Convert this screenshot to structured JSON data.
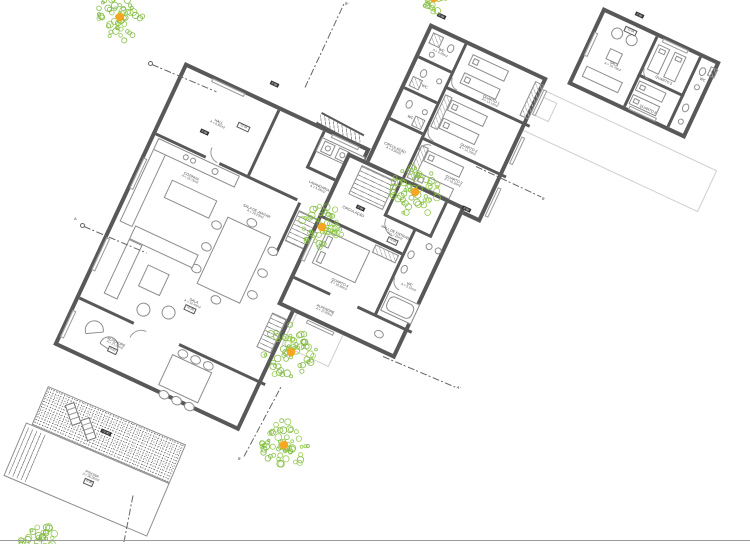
{
  "document": {
    "type": "architectural site / floor plan drawing",
    "language": "pt"
  },
  "palette": {
    "wall": "#585858",
    "line": "#8d8d8d",
    "faint": "#cfcfcf",
    "tree_green": "#8CC63E",
    "tree_green_dark": "#79B53A",
    "tree_dot": "#F5A623",
    "text": "#444444",
    "page_edge": "#9a9a9a"
  },
  "buildings": {
    "living": {
      "rooms": {
        "hall": {
          "name": "HALL",
          "area": "A = 9.60m2"
        },
        "lavandaria": {
          "name": "LAVANDARIA",
          "area": "A = 6.45m2"
        },
        "cozinha": {
          "name": "COZINHA",
          "area": "A = 18.75m2"
        },
        "jantar": {
          "name": "SALA DE JANTAR",
          "area": "A = 16.20m2"
        },
        "sala": {
          "name": "SALA",
          "area": "A = 32.40m2",
          "tag": "+0.05"
        },
        "alpendre": {
          "name": "ALPENDRE",
          "area": "A = 21.35m2",
          "tag": "0.00"
        }
      }
    },
    "bedrooms": {
      "rooms": {
        "wc1": {
          "name": "WC",
          "area": "A = 4.20m2"
        },
        "wc2": {
          "name": "WC",
          "area": "A = 3.80m2"
        },
        "wc3": {
          "name": "WC",
          "area": "A = 3.80m2"
        },
        "q1": {
          "name": "QUARTO 1",
          "area": "A = 14.10m2"
        },
        "q2": {
          "name": "QUARTO 2",
          "area": "A = 14.10m2"
        },
        "q3": {
          "name": "QUARTO 3",
          "area": "A = 15.30m2"
        },
        "circ": {
          "name": "CIRCULAÇÃO",
          "area": "A = 8.90m2"
        }
      }
    },
    "suite": {
      "rooms": {
        "hall": {
          "name": "HALL DE ENTRADA",
          "area": "A = 7.25m2",
          "tag": "+0.05"
        },
        "circ": {
          "name": "CIRCULAÇÃO",
          "area": "A = 6.40m2"
        },
        "quarto": {
          "name": "QUARTO 4",
          "area": "A = 16.80m2"
        },
        "wc": {
          "name": "WC",
          "area": "A = 5.10m2"
        },
        "alpendre": {
          "name": "ALPENDRE",
          "area": "A = 12.60m2"
        }
      }
    },
    "guest": {
      "rooms": {
        "sala": {
          "name": "SALA",
          "area": "A = 15.75m2"
        },
        "q5": {
          "name": "QUARTO 5",
          "area": "A = 12.40m2"
        },
        "q6": {
          "name": "QUARTO 6",
          "area": "A = 11.95m2"
        },
        "wc": {
          "name": "WC",
          "area": "A = 2.90m2"
        }
      }
    }
  },
  "pool": {
    "label": "PISCINA",
    "area": "A = 36.00m2",
    "tag": "-0.40",
    "deck_tag": "+0.40"
  },
  "levels": {
    "t1": "0.00",
    "t2": "+0.05",
    "t3": "0.00",
    "t4": "0.00",
    "t5": "0.00",
    "t6": "0.00",
    "t7": "+0.05",
    "t8": "0.00"
  },
  "sections": {
    "a": "A",
    "a_end": "A'",
    "b": "B",
    "b_end": "B'"
  },
  "trees": [
    {
      "x": 120,
      "y": 17,
      "r": 26,
      "dot": true
    },
    {
      "x": 434,
      "y": -2,
      "r": 15,
      "dot": true
    },
    {
      "x": 415,
      "y": 192,
      "r": 27,
      "dot": true
    },
    {
      "x": 322,
      "y": 227,
      "r": 24,
      "dot": true
    },
    {
      "x": 291,
      "y": 352,
      "r": 30,
      "dot": true
    },
    {
      "x": 284,
      "y": 445,
      "r": 27,
      "dot": true
    },
    {
      "x": 38,
      "y": 540,
      "r": 19,
      "dot": false
    }
  ]
}
